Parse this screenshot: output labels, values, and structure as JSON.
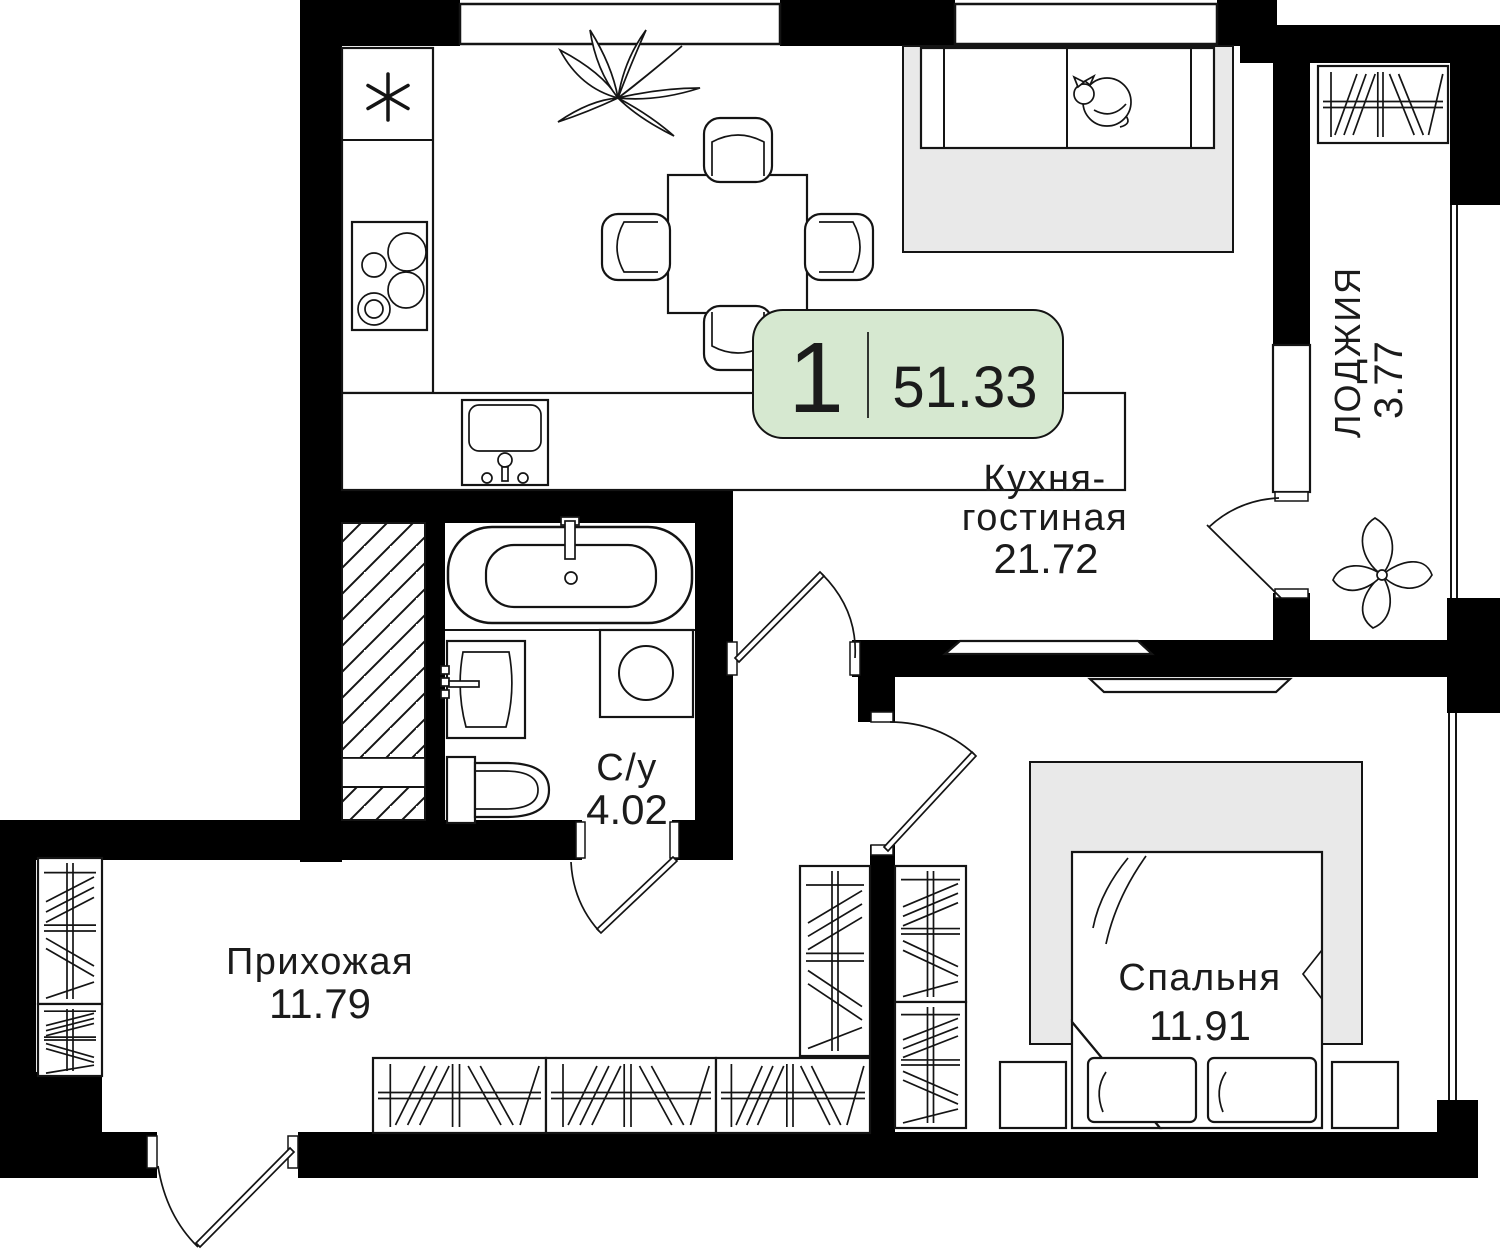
{
  "floor_plan": {
    "badge": {
      "rooms_count": "1",
      "total_area": "51.33"
    },
    "rooms": {
      "kitchen_living": {
        "name_line1": "Кухня-",
        "name_line2": "гостиная",
        "area": "21.72"
      },
      "loggia": {
        "name": "ЛОДЖИЯ",
        "area": "3.77"
      },
      "bathroom": {
        "name": "С/у",
        "area": "4.02"
      },
      "hallway": {
        "name": "Прихожая",
        "area": "11.79"
      },
      "bedroom": {
        "name": "Спальня",
        "area": "11.91"
      }
    },
    "colors": {
      "badge_bg": "#d6e8d0",
      "wall": "#000000",
      "soft_gray": "#e9e9e9",
      "line": "#141414"
    }
  }
}
